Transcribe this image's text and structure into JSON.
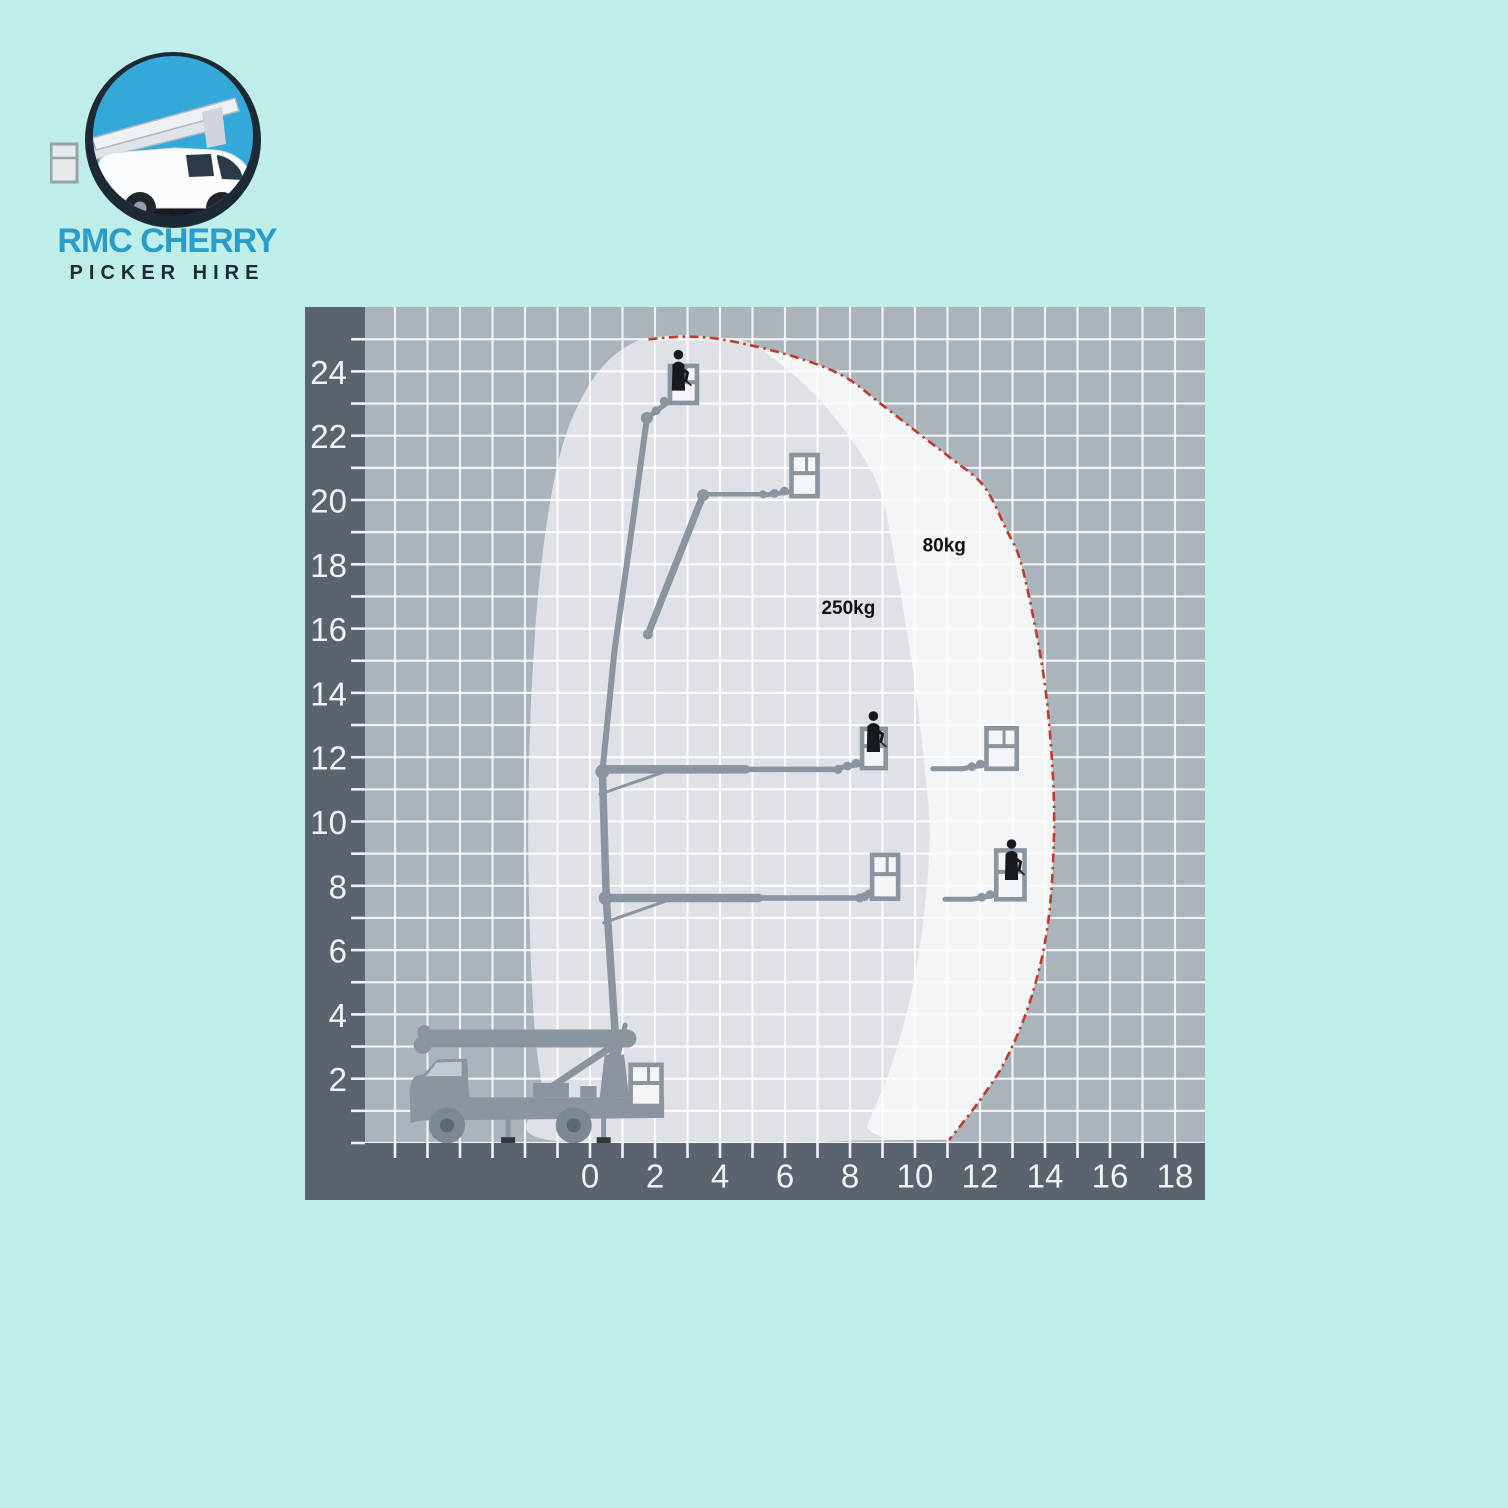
{
  "page": {
    "background": "#bfeee9"
  },
  "logo": {
    "title_line1": "RMC CHERRY",
    "title_line2": "PICKER HIRE",
    "line1_color": "#2b9dca",
    "line2_color": "#1e2a35",
    "badge_ring_color": "#1d2935",
    "badge_inner_color": "#35a8da",
    "vehicle": "cherry-picker-van-illustration"
  },
  "chart_data": {
    "type": "area",
    "title": "",
    "xlabel": "",
    "ylabel": "",
    "description": "Cherry picker working envelope: platform height (m) vs horizontal outreach (m)",
    "units": "m",
    "x_axis": {
      "tick_labels": [
        0,
        2,
        4,
        6,
        8,
        10,
        12,
        14,
        16,
        18
      ],
      "minor_ticks_from": -6,
      "minor_ticks_to": 18
    },
    "y_axis": {
      "tick_labels": [
        2,
        4,
        6,
        8,
        10,
        12,
        14,
        16,
        18,
        20,
        22,
        24
      ],
      "minor_ticks_from": 0,
      "minor_ticks_to": 25
    },
    "colors": {
      "axis_band": "#5a646e",
      "grid_bg": "#aab4bd",
      "grid_line": "rgba(255,255,255,0.82)",
      "tick": "#f0f3f4",
      "tick_label": "#f0f3f4",
      "boundary_red": "#c5392a",
      "annotation": "#111111"
    },
    "envelopes": [
      {
        "name": "80kg-zone",
        "label": "80kg",
        "max_outreach_m": 14.3,
        "max_height_m": 25,
        "fill": "#f3f5f6",
        "boundary_color": "#c5392a",
        "points": [
          [
            1.8,
            25.0
          ],
          [
            3.0,
            25.08
          ],
          [
            4.3,
            24.95
          ],
          [
            6.3,
            24.45
          ],
          [
            7.8,
            23.85
          ],
          [
            9.0,
            22.95
          ],
          [
            10.2,
            22.0
          ],
          [
            11.1,
            21.3
          ],
          [
            12.1,
            20.45
          ],
          [
            12.8,
            19.1
          ],
          [
            13.3,
            17.9
          ],
          [
            13.9,
            14.9
          ],
          [
            14.18,
            12.4
          ],
          [
            14.28,
            9.8
          ],
          [
            14.1,
            6.9
          ],
          [
            13.6,
            4.6
          ],
          [
            12.8,
            2.6
          ],
          [
            11.9,
            1.2
          ],
          [
            11.05,
            0.1
          ]
        ]
      },
      {
        "name": "250kg-zone",
        "label": "250kg",
        "max_outreach_m": 10.5,
        "max_height_m": 25,
        "fill": "#dee2e6",
        "points": [
          [
            2.6,
            25.12
          ],
          [
            3.9,
            25.05
          ],
          [
            4.9,
            24.88
          ],
          [
            6.2,
            23.95
          ],
          [
            7.5,
            22.6
          ],
          [
            8.8,
            20.6
          ],
          [
            9.35,
            18.3
          ],
          [
            9.95,
            14.6
          ],
          [
            10.3,
            11.6
          ],
          [
            10.45,
            9.3
          ],
          [
            10.1,
            5.8
          ],
          [
            9.4,
            2.8
          ],
          [
            8.55,
            0.6
          ],
          [
            8.3,
            0.08
          ],
          [
            -1.2,
            0.08
          ],
          [
            -1.45,
            1.6
          ],
          [
            -1.7,
            3.5
          ],
          [
            -1.85,
            6.5
          ],
          [
            -1.9,
            10.0
          ],
          [
            -1.8,
            14.0
          ],
          [
            -1.5,
            18.0
          ],
          [
            -0.9,
            21.5
          ],
          [
            0.05,
            23.7
          ],
          [
            1.25,
            24.85
          ]
        ]
      }
    ],
    "annotations": [
      {
        "text": "80kg",
        "x": 10.9,
        "y": 18.4
      },
      {
        "text": "250kg",
        "x": 7.95,
        "y": 16.45
      }
    ],
    "machine": {
      "color": "#8a95a0",
      "person_color": "#16191d",
      "basket_fill": "#f3f5f6",
      "dark_detail": "#30373d",
      "mast_sections": [
        {
          "pts": [
            [
              0.62,
              1.45
            ],
            [
              0.78,
              3.3
            ]
          ],
          "w": 9
        },
        {
          "pts": [
            [
              0.78,
              3.3
            ],
            [
              0.5,
              7.6
            ],
            [
              0.38,
              11.55
            ]
          ],
          "w": 7.5
        },
        {
          "pts": [
            [
              0.38,
              11.55
            ],
            [
              0.75,
              15.3
            ],
            [
              1.3,
              19.2
            ],
            [
              1.75,
              22.55
            ]
          ],
          "w": 6
        }
      ],
      "booms": [
        {
          "pts": [
            [
              0.38,
              11.62
            ],
            [
              4.8,
              11.62
            ]
          ],
          "w": 8.5
        },
        {
          "pts": [
            [
              4.8,
              11.62
            ],
            [
              7.63,
              11.62
            ]
          ],
          "w": 5.5
        },
        {
          "pts": [
            [
              0.48,
              7.62
            ],
            [
              5.2,
              7.62
            ]
          ],
          "w": 8.5
        },
        {
          "pts": [
            [
              5.2,
              7.62
            ],
            [
              8.3,
              7.62
            ]
          ],
          "w": 5.5
        },
        {
          "pts": [
            [
              1.78,
              15.82
            ],
            [
              3.48,
              20.15
            ]
          ],
          "w": 7
        },
        {
          "pts": [
            [
              3.48,
              20.18
            ],
            [
              5.32,
              20.18
            ]
          ],
          "w": 4.5
        },
        {
          "pts": [
            [
              10.55,
              11.64
            ],
            [
              11.45,
              11.64
            ]
          ],
          "w": 5
        },
        {
          "pts": [
            [
              10.92,
              7.58
            ],
            [
              11.75,
              7.58
            ]
          ],
          "w": 5
        },
        {
          "pts": [
            [
              0.3,
              10.85
            ],
            [
              2.3,
              11.55
            ]
          ],
          "w": 3
        },
        {
          "pts": [
            [
              0.42,
              6.85
            ],
            [
              2.4,
              7.55
            ]
          ],
          "w": 3
        }
      ],
      "joints": [
        [
          0.38,
          11.55,
          7
        ],
        [
          0.48,
          7.62,
          7
        ],
        [
          1.75,
          22.55,
          6
        ],
        [
          3.48,
          20.15,
          6
        ],
        [
          1.78,
          15.82,
          5
        ],
        [
          0.78,
          3.3,
          8
        ],
        [
          7.63,
          11.62,
          4.5
        ],
        [
          8.3,
          7.62,
          4.5
        ],
        [
          5.32,
          20.18,
          4
        ]
      ],
      "baskets": [
        {
          "x": 2.46,
          "y": 23.02,
          "w": 0.83,
          "h": 1.15,
          "attach": [
            1.75,
            22.55
          ],
          "person": [
            2.72,
            24.52
          ]
        },
        {
          "x": 6.2,
          "y": 20.12,
          "w": 0.8,
          "h": 1.28,
          "attach": [
            5.32,
            20.15
          ],
          "person": null
        },
        {
          "x": 8.37,
          "y": 11.66,
          "w": 0.73,
          "h": 1.22,
          "attach": [
            7.63,
            11.66
          ],
          "person": [
            8.72,
            13.28
          ]
        },
        {
          "x": 8.68,
          "y": 7.6,
          "w": 0.8,
          "h": 1.36,
          "attach": [
            8.3,
            7.6
          ],
          "person": null
        },
        {
          "x": 12.2,
          "y": 11.64,
          "w": 0.93,
          "h": 1.26,
          "attach": [
            11.45,
            11.64
          ],
          "person": null
        },
        {
          "x": 12.5,
          "y": 7.58,
          "w": 0.87,
          "h": 1.52,
          "attach": [
            11.75,
            7.58
          ],
          "person": [
            12.97,
            9.3
          ]
        },
        {
          "x": 1.25,
          "y": 1.15,
          "w": 0.95,
          "h": 1.28,
          "attach": [
            0.3,
            1.05
          ],
          "person": null
        }
      ],
      "truck": {
        "present": true,
        "front_x_m": -5.5,
        "rear_x_m": 2.3,
        "stowed_boom_height_m": 3.55
      }
    }
  }
}
